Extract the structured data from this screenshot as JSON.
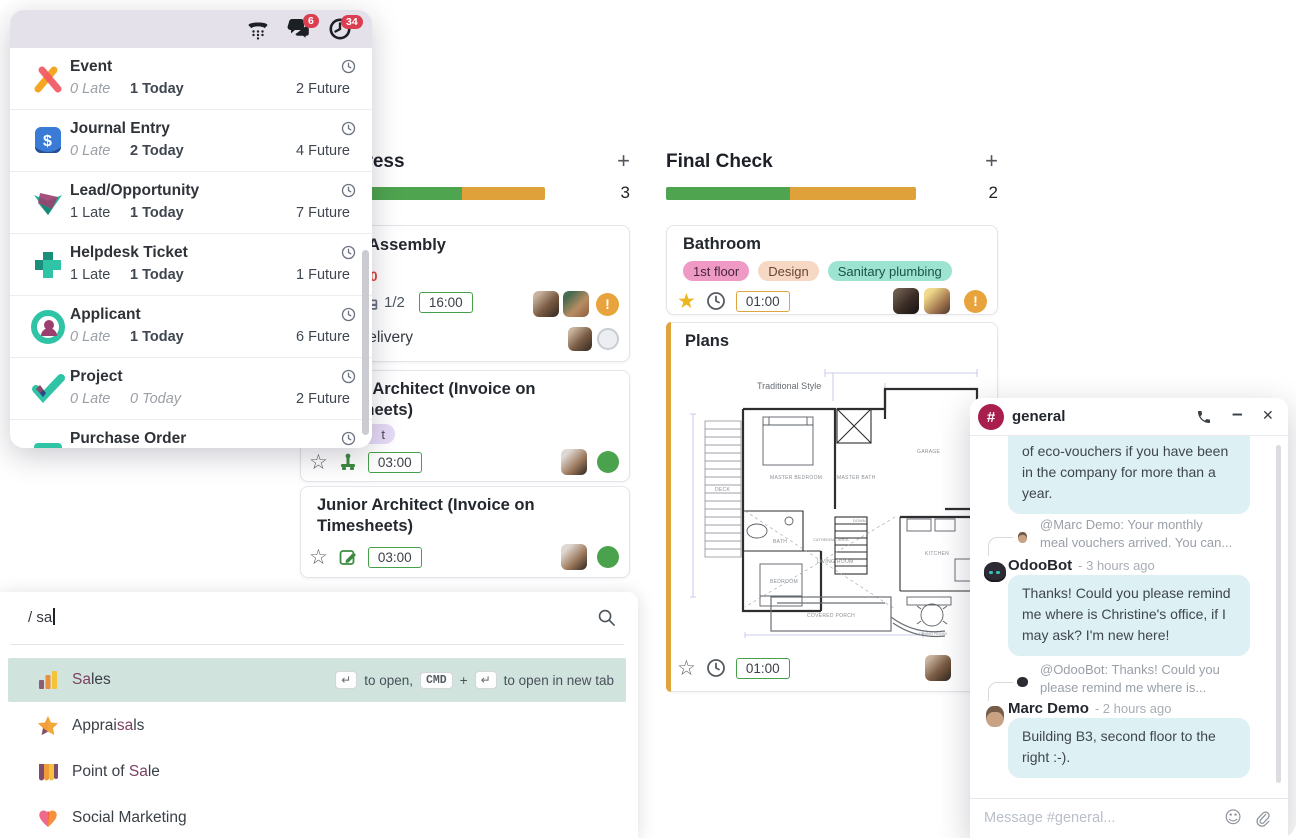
{
  "colors": {
    "accent_purple": "#714b67",
    "match_highlight": "#7d3f63",
    "progress_green": "#4fa44f",
    "progress_orange": "#dfa23b",
    "badge_red": "#dc3e51",
    "focused_row_teal": "#d0e3dd",
    "chat_bubble_cyan": "#ddf0f3",
    "channel_logo_crimson": "#a81e4d",
    "panel_header_lavender": "#e4e1ea",
    "card_accent_yellow": "#dfa43e"
  },
  "icons": {
    "voip_phone": "phone-handset-over-dial-pad",
    "messages": "chat-bubbles",
    "activities": "clock",
    "row_activity": "clock-outline",
    "search": "magnifier",
    "enter_key": "↵",
    "emoji": "☺",
    "attachment": "paperclip",
    "priority_star_empty": "☆",
    "priority_star_filled": "★",
    "warning": "!",
    "add_column": "+",
    "minimize": "–",
    "close": "×"
  },
  "activity_panel": {
    "header": {
      "badges": {
        "messages": "6",
        "activities": "34"
      }
    },
    "items": [
      {
        "label": "Event",
        "late": "0 Late",
        "today": "1 Today",
        "future": "2 Future"
      },
      {
        "label": "Journal Entry",
        "late": "0 Late",
        "today": "2 Today",
        "future": "4 Future"
      },
      {
        "label": "Lead/Opportunity",
        "late": "1 Late",
        "today": "1 Today",
        "future": "7 Future"
      },
      {
        "label": "Helpdesk Ticket",
        "late": "1 Late",
        "today": "1 Today",
        "future": "1 Future"
      },
      {
        "label": "Applicant",
        "late": "0 Late",
        "today": "1 Today",
        "future": "6 Future"
      },
      {
        "label": "Project",
        "late": "0 Late",
        "today": "0 Today",
        "future": "2 Future"
      },
      {
        "label": "Purchase Order"
      }
    ]
  },
  "kanban": {
    "columns": [
      {
        "title": "In Progress",
        "count": "3",
        "add": "+",
        "cards": [
          {
            "title": "Assembly",
            "overdue_fragment": "0",
            "subtask_count": "1/2",
            "hours": "16:00",
            "subtask_row": {
              "title": "Delivery"
            }
          },
          {
            "title_l1": "Senior Architect (Invoice on",
            "title_l2": "Timesheets)",
            "tag_fragment": "t",
            "hours": "03:00"
          },
          {
            "title_l1": "Junior Architect (Invoice on",
            "title_l2": "Timesheets)",
            "hours": "03:00"
          }
        ]
      },
      {
        "title": "Final Check",
        "count": "2",
        "add": "+",
        "cards": [
          {
            "title": "Bathroom",
            "tags": [
              "1st floor",
              "Design",
              "Sanitary plumbing"
            ],
            "hours": "01:00"
          },
          {
            "title": "Plans",
            "hours": "01:00",
            "floorplan": {
              "style": "Traditional Style",
              "master_bedroom": "MASTER BEDROOM",
              "master_bath": "MASTER BATH",
              "garage": "GARAGE",
              "deck": "DECK",
              "bath": "BATH",
              "bedroom": "BEDROOM",
              "cathedral": "CATHEDRAL AREA",
              "living_room": "LIVING ROOM",
              "kitchen": "KITCHEN",
              "dining": "DINING ROOM",
              "porch": "COVERED PORCH",
              "down": "DOWN"
            }
          }
        ]
      }
    ]
  },
  "command_palette": {
    "query": "/ sa",
    "results": [
      {
        "segments": [
          {
            "t": "Sa",
            "m": true
          },
          {
            "t": "les",
            "m": false
          }
        ]
      },
      {
        "segments": [
          {
            "t": "Apprai",
            "m": false
          },
          {
            "t": "sa",
            "m": true
          },
          {
            "t": "ls",
            "m": false
          }
        ]
      },
      {
        "segments": [
          {
            "t": "Point of ",
            "m": false
          },
          {
            "t": "Sa",
            "m": true
          },
          {
            "t": "le",
            "m": false
          }
        ]
      },
      {
        "segments": [
          {
            "t": "Social Marketing",
            "m": false
          }
        ]
      }
    ],
    "hint": {
      "enter": "↵",
      "open": "to open,",
      "cmd": "CMD",
      "plus": "+",
      "enter2": "↵",
      "newtab": "to open in new tab"
    }
  },
  "chat": {
    "title": "general",
    "bubble1": {
      "lines": [
        "of eco-vouchers if you have been",
        "in the company for more than a",
        "year."
      ]
    },
    "reply1": {
      "lines": [
        "@Marc Demo:  Your monthly",
        "meal vouchers arrived. You can..."
      ]
    },
    "odoobot": {
      "name": "OdooBot",
      "time": "- 3 hours ago",
      "lines": [
        "Thanks! Could you please remind",
        "me where is Christine's office, if I",
        "may ask? I'm new here!"
      ]
    },
    "reply2": {
      "lines": [
        "@OdooBot:  Thanks! Could you",
        "please remind me where is..."
      ]
    },
    "marc": {
      "name": "Marc Demo",
      "time": "- 2 hours ago",
      "lines": [
        "Building B3, second floor to the",
        "right :-)."
      ]
    },
    "composer_placeholder": "Message #general..."
  }
}
